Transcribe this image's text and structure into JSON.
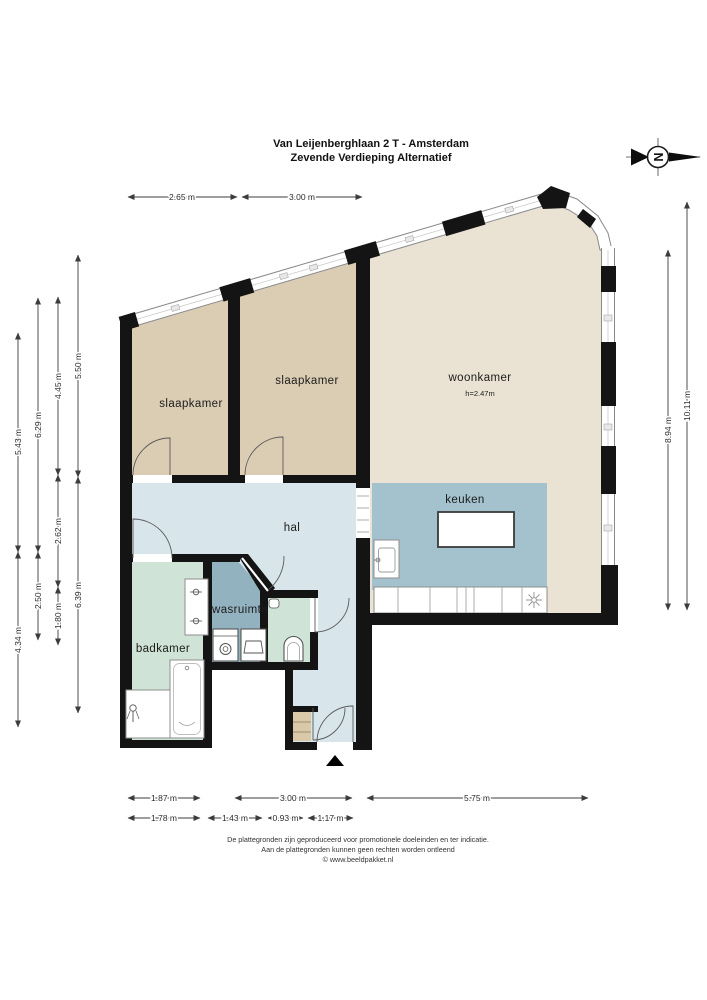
{
  "title": {
    "line1": "Van Leijenberghlaan 2 T - Amsterdam",
    "line2": "Zevende Verdieping Alternatief"
  },
  "compass": {
    "letter": "N"
  },
  "rooms": {
    "slaapkamer1": {
      "label": "slaapkamer"
    },
    "slaapkamer2": {
      "label": "slaapkamer"
    },
    "woonkamer": {
      "label": "woonkamer",
      "height_note": "h=2.47m"
    },
    "keuken": {
      "label": "keuken"
    },
    "hal": {
      "label": "hal"
    },
    "wasruimte": {
      "label": "wasruimte"
    },
    "badkamer": {
      "label": "badkamer"
    }
  },
  "dims": {
    "top": [
      "2.65 m",
      "3.00 m"
    ],
    "left": [
      "5.43 m",
      "4.34 m",
      "6.29 m",
      "2.50 m",
      "4.45 m",
      "2.62 m",
      "1.80 m",
      "5.50 m",
      "6.39 m"
    ],
    "right": [
      "8.94 m",
      "10.11 m"
    ],
    "bottom1": [
      "1.87 m",
      "3.00 m",
      "5.75 m"
    ],
    "bottom2": [
      "1.78 m",
      "1.43 m",
      "0.93 m",
      "1.17 m"
    ]
  },
  "footer": {
    "line1": "De plattegronden zijn geproduceerd voor promotionele doeleinden en ter indicatie.",
    "line2": "Aan de plattegronden kunnen geen rechten worden ontleend",
    "line3": "© www.beeldpakket.nl"
  },
  "colors": {
    "wall": "#141414",
    "bedroom_floor": "#dbcdb3",
    "living_floor": "#eae2d3",
    "kitchen_floor": "#a3c2cd",
    "hall_floor": "#d8e5ea",
    "bath_floor": "#cfe4d6",
    "laundry_floor": "#92b2c0",
    "closet_floor": "#d9c9a8"
  }
}
